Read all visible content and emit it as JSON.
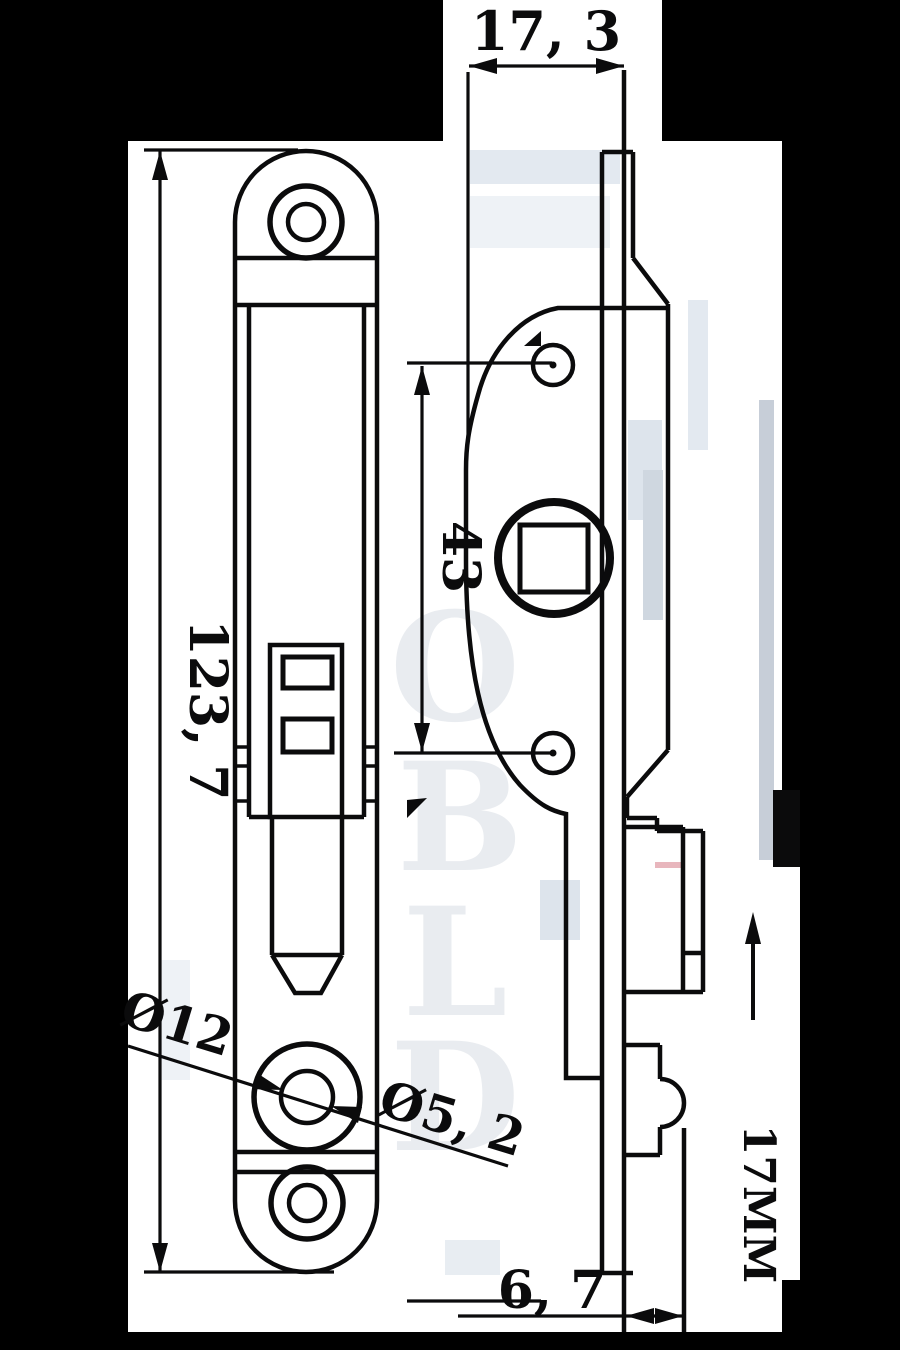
{
  "dims": {
    "top_width": "17, 3",
    "plate_height": "123, 7",
    "hole_spacing": "43",
    "outer_hole_dia": "Ø12",
    "inner_hole_dia": "Ø5, 2",
    "bottom_offset": "6, 7",
    "stroke_travel": "17MM"
  },
  "watermark": {
    "l1": "O",
    "l2": "B",
    "l3": "L",
    "l4": "D"
  },
  "colors": {
    "ink": "#0b0b0c",
    "paper": "#ffffff",
    "background": "#000000",
    "artifact": "#dde4ec"
  }
}
